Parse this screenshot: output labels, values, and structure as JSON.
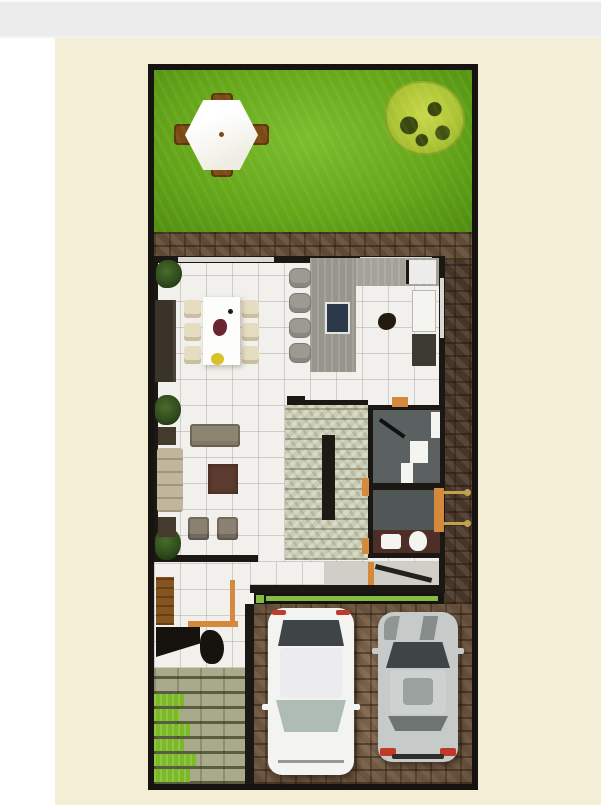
{
  "meta": {
    "width": 601,
    "height": 805,
    "kind": "3d-floor-plan-top-view-render",
    "visible_text": "none"
  },
  "colors": {
    "page-white": "#ffffff",
    "topbar-gray": "#ececec",
    "topbar-line": "#fafafa",
    "canvas-cream": "#f5eed6",
    "frame-black": "#171310",
    "grass-light": "#7cbd2e",
    "grass-mid": "#66a71a",
    "grass-dark": "#4f8c0f",
    "tree-yellow": "#c9d84a",
    "tree-dark": "#39480c",
    "patio-white": "#efede2",
    "chair-brown": "#7b4a15",
    "brick-base": "#5f4a36",
    "brick-dark": "#46362a",
    "drive-base": "#7a614a",
    "floor-white": "#f1f0ec",
    "wall-black": "#1b1713",
    "counter-gray": "#97968c",
    "cooktop-navy": "#2c3948",
    "stool-gray": "#9c9b92",
    "chair-cream": "#e6ddc1",
    "sofa-taupe": "#8d8471",
    "sofa-tan": "#bfb69b",
    "coffee-maroon": "#5d3c30",
    "side-dark": "#453a2e",
    "stairs-base": "#c9ccb3",
    "bath-floor": "#5b6060",
    "vanity-maroon": "#4e2e26",
    "fixture-white": "#f4f4f1",
    "accent-orange": "#d4893c",
    "knob-gold": "#c2a14e",
    "green-bar": "#87ba45",
    "walk-paver": "#a9aa8c",
    "walk-green": "#7cb926",
    "plant-green": "#2f4d1c",
    "car-white": "#f3f3f1",
    "car-silver": "#c6cbc9",
    "glass-dark": "#3f4547",
    "glass-front": "#aebcb4",
    "tail-red": "#c03a2a"
  },
  "scene": {
    "description": "Top-down 3D architectural render of a narrow lot house on a cream page with a gray bar at top",
    "regions": [
      {
        "name": "backyard-lawn",
        "objects": [
          "hexagonal-patio-table",
          "four-brown-chairs",
          "yellow-green-tree"
        ]
      },
      {
        "name": "patio-paving-strip",
        "objects": [
          "brick-pavers"
        ]
      },
      {
        "name": "dining-area",
        "objects": [
          "white-dining-table",
          "six-cream-chairs",
          "dark-console",
          "wall-plants",
          "flower-centerpiece",
          "fruit-bowl"
        ]
      },
      {
        "name": "kitchen",
        "objects": [
          "gray-island-counter",
          "navy-cooktop",
          "four-bar-stools",
          "white-fridge",
          "dark-counter",
          "floor-object"
        ]
      },
      {
        "name": "living-room",
        "objects": [
          "taupe-sofa",
          "tan-loveseat",
          "maroon-coffee-table",
          "two-armchairs",
          "two-side-tables"
        ]
      },
      {
        "name": "staircase",
        "objects": [
          "stone-steps",
          "dark-railing"
        ]
      },
      {
        "name": "bathroom-block",
        "objects": [
          "shower-tray",
          "sink-unit",
          "toilet",
          "vanity",
          "orange-doors",
          "gold-door-knobs"
        ]
      },
      {
        "name": "entry",
        "objects": [
          "wood-panel",
          "angled-black-console",
          "dark-figure",
          "orange-step"
        ]
      },
      {
        "name": "garage-driveway",
        "objects": [
          "green-garage-door-bar",
          "white-car-top-view",
          "silver-car-top-view",
          "brick-pavers"
        ]
      },
      {
        "name": "entry-walkway",
        "objects": [
          "paver-strips",
          "grass-strips"
        ]
      }
    ]
  }
}
